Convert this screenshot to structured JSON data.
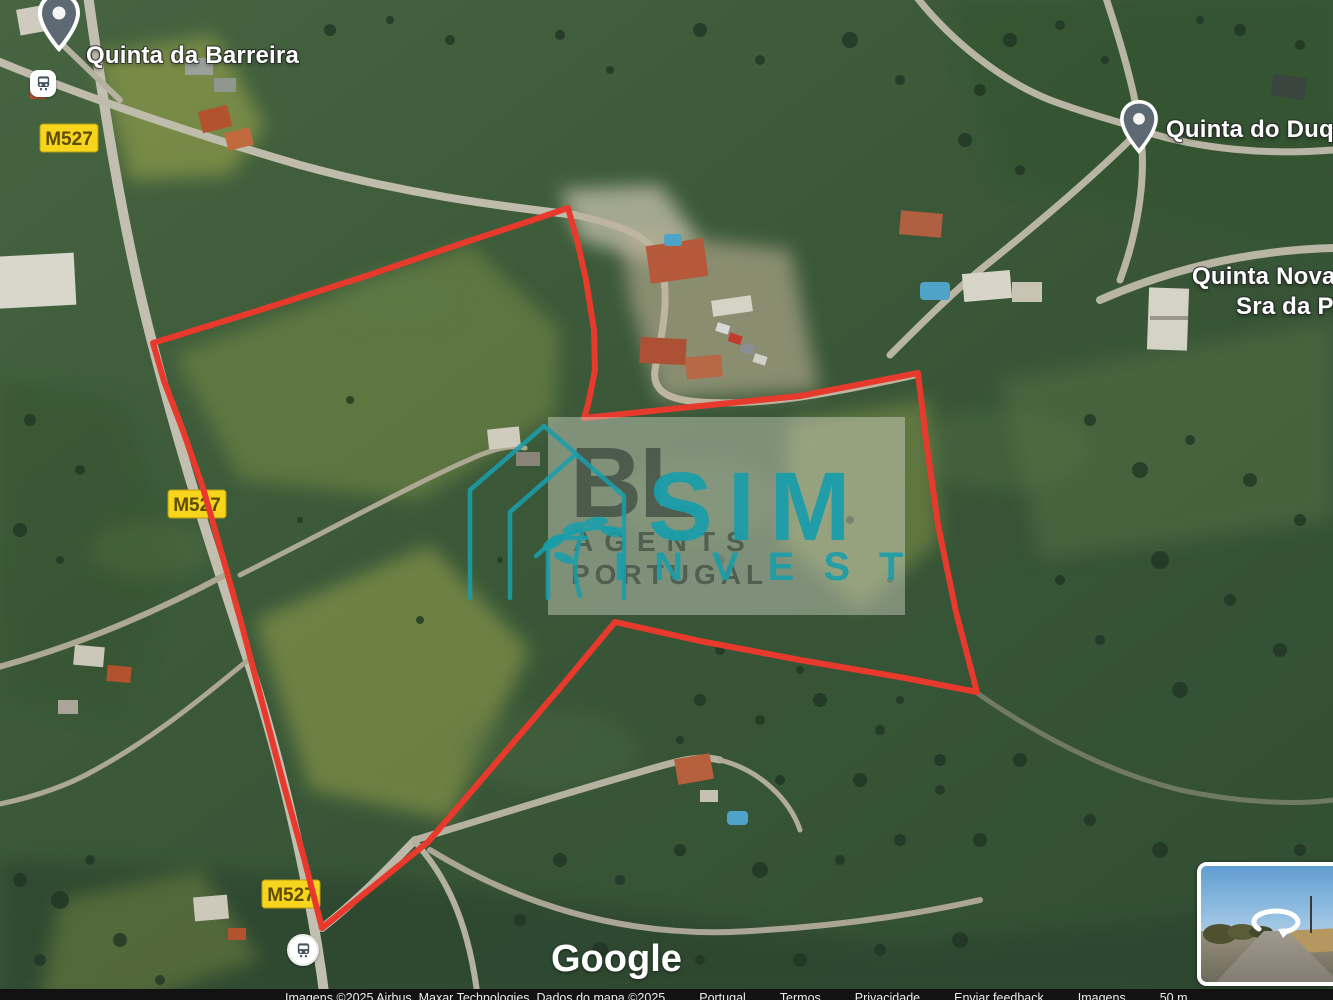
{
  "map": {
    "labels": {
      "quinta_da_barreira": "Quinta da Barreira",
      "quinta_do_duque": "Quinta do Duque",
      "quinta_nova_line1": "Quinta Nova Nos",
      "quinta_nova_line2": "Sra da Pieda"
    },
    "road_badge": "M527"
  },
  "watermark": {
    "bl": "BL",
    "agents": "AGENTS",
    "portugal": "PORTUGAL",
    "sim": "SIM",
    "invest": "INVEST"
  },
  "footer": {
    "google_logo": "Google",
    "attribution_imagery": "Imagens ©2025 Airbus, Maxar Technologies, Dados do mapa ©2025",
    "links": [
      "Portugal",
      "Termos",
      "Privacidade",
      "Enviar feedback",
      "Imagens",
      "50 m"
    ]
  },
  "colors": {
    "boundary_red": "#e8392d",
    "badge_bg": "#f7d51c",
    "badge_border": "#b89b10",
    "badge_text": "#5e4c00",
    "teal": "#1a9daa",
    "pin_fill": "#5d6a74",
    "pool_blue": "#4fa3c8"
  },
  "icons": {
    "place_pin": "map-pin-icon",
    "bus_stop": "bus-icon",
    "streetview_arrow": "rotate-arrow-icon",
    "house_logo": "house-leaf-logo-icon"
  }
}
